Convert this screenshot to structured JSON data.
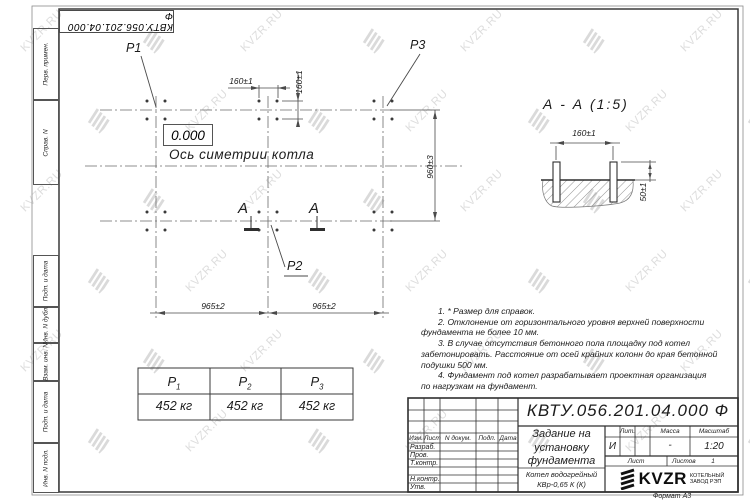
{
  "watermark": {
    "text": "KVZR.RU"
  },
  "frame": {
    "stamp_top": "КВТУ.056.201.04.000  Ф",
    "format_note": "Формат А3"
  },
  "sidebar": {
    "items": [
      "Перв. примен.",
      "Справ. N",
      "Подп. и дата",
      "Инв. N дубл.",
      "Взам. инв. N",
      "Подп. и дата",
      "Инв. N подл."
    ]
  },
  "plan": {
    "point_labels": {
      "p1": "P1",
      "p2": "P2",
      "p3": "P3"
    },
    "elevation": "0.000",
    "axis_label": "Ось симетрии котла",
    "section_letter_left": "А",
    "section_letter_right": "А",
    "dims": {
      "top_160": "160±1",
      "side_160": "160±1",
      "right_960": "960±3",
      "bottom_left_965": "965±2",
      "bottom_right_965": "965±2"
    }
  },
  "section": {
    "title": "А - А (1:5)",
    "dims": {
      "width_160": "160±1",
      "height_50": "50±1"
    }
  },
  "load_table": {
    "headers": [
      {
        "base": "P",
        "sub": "1"
      },
      {
        "base": "P",
        "sub": "2"
      },
      {
        "base": "P",
        "sub": "3"
      }
    ],
    "values": [
      "452 кг",
      "452 кг",
      "452 кг"
    ]
  },
  "notes": {
    "lines": [
      "1. * Размер для справок.",
      "2. Отклонение от горизонтального уровня верхней поверхности",
      "фундамента не более 10 мм.",
      "3. В случае отсутствия бетонного пола площадку под котел",
      "забетонировать. Расстояние от осей крайних колонн до края бетонной",
      "подушки 500 мм.",
      "4. Фундамент под котел разрабатывает проектная организация",
      "по нагрузкам на фундамент."
    ]
  },
  "title_block": {
    "doc_number": "КВТУ.056.201.04.000  Ф",
    "title_lines": [
      "Задание на",
      "установку",
      "фундамента"
    ],
    "product_lines": [
      "Котел водогрейный",
      "КВр-0,65 К (К)"
    ],
    "columns": [
      "Изм.",
      "Лист",
      "N докум.",
      "Подп.",
      "Дата"
    ],
    "rows": [
      "Разраб.",
      "Пров.",
      "Т.контр.",
      "Н.контр.",
      "Утв."
    ],
    "lit_label": "Лит.",
    "lit_value": "И",
    "mass_label": "Масса",
    "mass_value": "-",
    "scale_label": "Масштаб",
    "scale_value": "1:20",
    "sheet_label": "Лист",
    "sheets_label": "Листов",
    "sheets_value": "1",
    "logo_text": "KVZR",
    "logo_sub1": "КОТЕЛЬНЫЙ",
    "logo_sub2": "ЗАВОД РЭП"
  }
}
